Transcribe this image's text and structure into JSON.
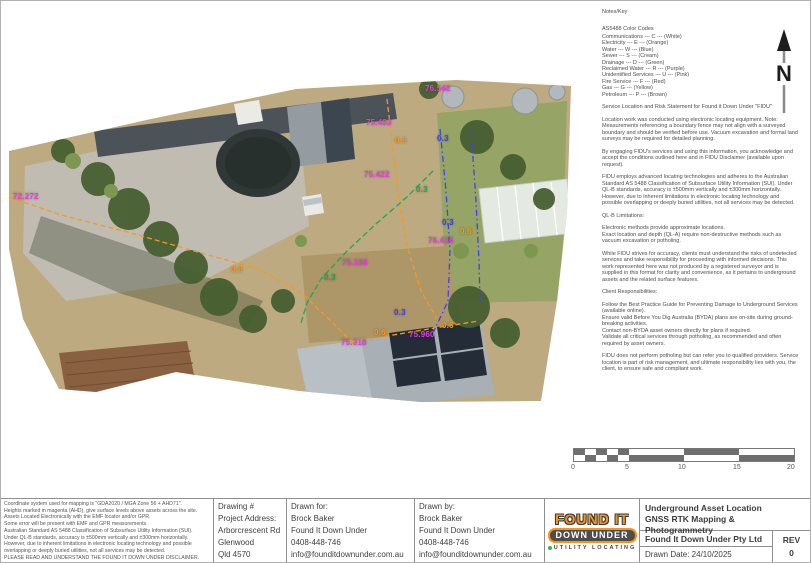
{
  "notes": {
    "heading": "Notes/Key",
    "color_codes_title": "AS5488 Color Codes",
    "color_codes": [
      "Communications --- C --- (White)",
      "Electricity --- E --- (Orange)",
      "Water --- W --- (Blue)",
      "Sewer --- S --- (Cream)",
      "Drainage --- D --- (Green)",
      "Reclaimed Water --- R --- (Purple)",
      "Unidentified Services --- U --- (Pink)",
      "Fire Service --- F --- (Red)",
      "Gas --- G --- (Yellow)",
      "Petroleum --- P --- (Brown)"
    ],
    "sections": [
      "Service Location and Risk Statement for Found it Down Under \"FIDU\"",
      "Location work was conducted using electronic locating equipment. Note: Measurements referencing a boundary fence may not align with a surveyed boundary and should be verified before use. Vacuum excavation and formal land surveys may be required for detailed planning.",
      "By engaging FIDU's services and using this information, you acknowledge and accept the conditions outlined here and in FIDU Disclaimer (available upon request).",
      "FIDU employs advanced locating technologies and adheres to the Australian Standard AS 5488 Classification of Subsurface Utility Information (SUI). Under QL-B standards, accuracy is ±500mm vertically and ±300mm horizontally. However, due to inherent limitations in electronic locating technology and possible overlapping or deeply buried utilities, not all services may be detected.",
      "QL-B Limitations:",
      "Electronic methods provide approximate locations.\nExact location and depth (QL-A) require non-destructive methods such as vacuum excavation or potholing.",
      "While FIDU strives for accuracy, clients must understand the risks of undetected services and take responsibility for proceeding with informed decisions. This work represented here was not produced by a registered surveyor and is supplied in this format for clarity and convenience, as it pertains to underground assets and the related surface features.",
      "Client Responsibilities:",
      "Follow the Best Practice Guide for Preventing Damage to Underground Services (available online).\nEnsure valid Before You Dig Australia (BYDA) plans are on-site during ground-breaking activities.\nContact non-BYDA asset owners directly for plans if required.\nValidate all critical services through potholing, as recommended and often required by asset owners.",
      "FIDU does not perform potholing but can refer you to qualified providers. Service location is part of risk management, and ultimate responsibility lies with you, the client, to ensure safe and compliant work."
    ]
  },
  "map": {
    "colors": {
      "magenta": "#e93ce0",
      "orange": "#f59a1c",
      "blue": "#4040f2",
      "green": "#1fa84f"
    },
    "annotations": [
      {
        "text": "72.272",
        "color": "magenta",
        "x": 12,
        "y": 191
      },
      {
        "text": "76.542",
        "color": "magenta",
        "x": 424,
        "y": 83
      },
      {
        "text": "75.483",
        "color": "magenta",
        "x": 365,
        "y": 117
      },
      {
        "text": "0.6",
        "color": "orange",
        "x": 394,
        "y": 135
      },
      {
        "text": "0.3",
        "color": "blue",
        "x": 436,
        "y": 133
      },
      {
        "text": "75.422",
        "color": "magenta",
        "x": 363,
        "y": 169
      },
      {
        "text": "0.3",
        "color": "green",
        "x": 415,
        "y": 184
      },
      {
        "text": "0.3",
        "color": "blue",
        "x": 441,
        "y": 217
      },
      {
        "text": "0.6",
        "color": "orange",
        "x": 459,
        "y": 226
      },
      {
        "text": "76.436",
        "color": "magenta",
        "x": 427,
        "y": 235
      },
      {
        "text": "75.188",
        "color": "magenta",
        "x": 341,
        "y": 257
      },
      {
        "text": "0.3",
        "color": "green",
        "x": 323,
        "y": 272
      },
      {
        "text": "0.6",
        "color": "orange",
        "x": 230,
        "y": 264
      },
      {
        "text": "0.3",
        "color": "blue",
        "x": 393,
        "y": 307
      },
      {
        "text": "75.960",
        "color": "magenta",
        "x": 408,
        "y": 329
      },
      {
        "text": "0.6",
        "color": "orange",
        "x": 373,
        "y": 327
      },
      {
        "text": "0.6",
        "color": "orange",
        "x": 441,
        "y": 320
      },
      {
        "text": "75.318",
        "color": "magenta",
        "x": 340,
        "y": 337
      }
    ],
    "utility_lines": [
      {
        "color": "orange",
        "points": "8,196 60,214 130,232 200,252 258,268 300,292 330,320 352,342"
      },
      {
        "color": "orange",
        "points": "352,342 392,334 440,326 478,320"
      },
      {
        "color": "orange",
        "points": "386,98 392,150 398,200 407,248 420,290 436,318"
      },
      {
        "color": "blue",
        "points": "439,128 445,190 449,250 447,300 432,332"
      },
      {
        "color": "blue",
        "points": "470,128 475,200 478,260 479,300"
      },
      {
        "color": "green",
        "points": "432,170 406,196 376,222 346,250 320,278 306,302 300,322"
      }
    ],
    "north_label": "N"
  },
  "scale": {
    "labels": [
      "0",
      "5",
      "10",
      "15",
      "20"
    ]
  },
  "titleblock": {
    "disclaimer_lines": [
      "Coordinate system used for mapping is \"GDA2020 / MGA Zone 56 + AHD71\".",
      "Heights marked in magenta (AHD), give surface levels above assets across the site.",
      "Assets Located Electronically with the EMF locator and/or GPR.",
      "Some error will be present with EMF and GPR measurements.",
      "Australian Standard AS 5488 Classification of Subsurface Utility Information (SUI).",
      "Under QL-B standards, accuracy is ±500mm vertically and ±300mm horizontally.",
      "However, due to inherent limitations in electronic locating technology and possible",
      "overlapping or deeply buried utilities, not all services may be detected.",
      "PLEASE READ AND UNDERSTAND THE FOUND IT DOWN UNDER DISCLAIMER."
    ],
    "project": {
      "lines": [
        "Drawing #",
        "Project Address:",
        "Arborcrescent Rd",
        "Glenwood",
        "Qld 4570"
      ]
    },
    "drawn_for": {
      "lines": [
        "Drawn for:",
        "Brock Baker",
        "Found It Down Under",
        "0408-448-746",
        "info@founditdownunder.com.au"
      ]
    },
    "drawn_by": {
      "lines": [
        "Drawn by:",
        "Brock Baker",
        "Found It Down Under",
        "0408-448-746",
        "info@founditdownunder.com.au"
      ]
    },
    "logo": {
      "line1": "FOUND IT",
      "line2": "DOWN UNDER",
      "line3": "UTILITY LOCATING"
    },
    "info": {
      "title1": "Underground Asset Location",
      "title2": "GNSS RTK Mapping & Photogrammetry",
      "company": "Found It Down Under Pty Ltd",
      "rev_label": "REV",
      "rev_value": "0",
      "date": "Drawn Date: 24/10/2025"
    }
  }
}
